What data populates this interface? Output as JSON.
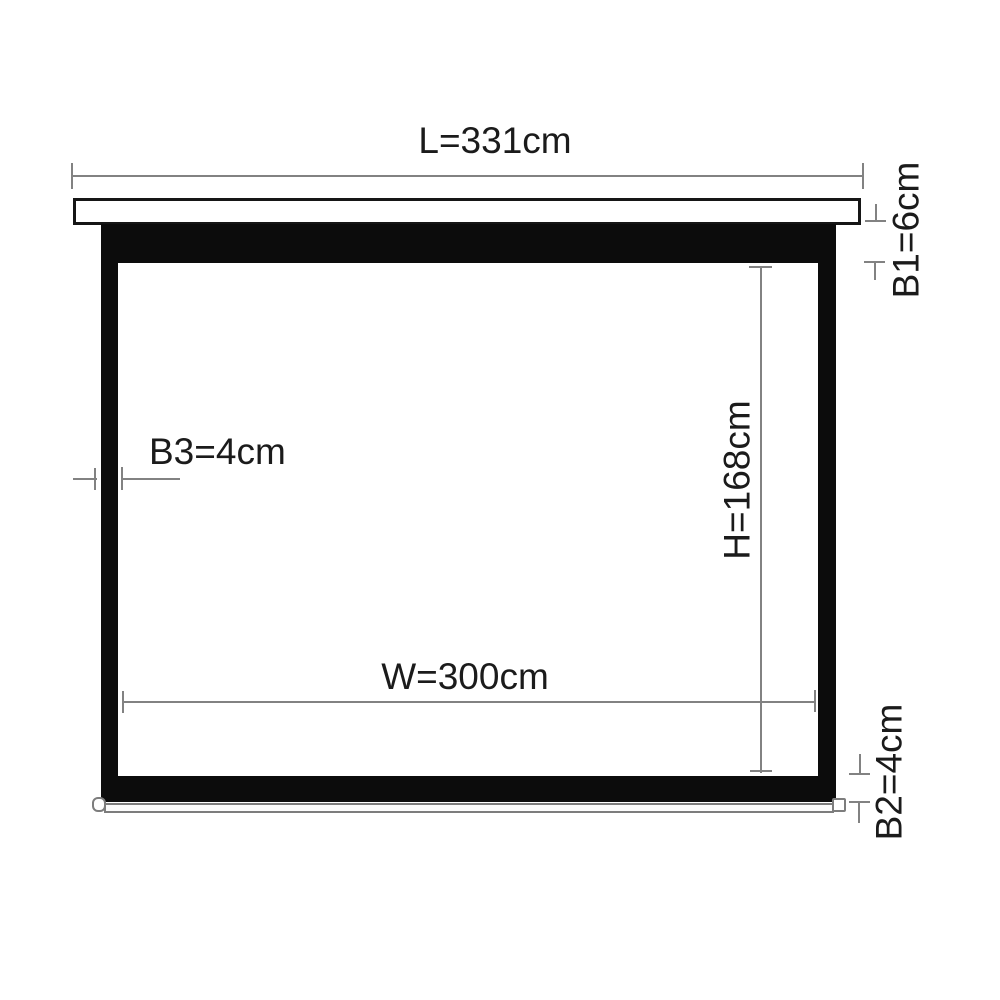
{
  "diagram": {
    "description_labels": {
      "length": "L=331cm",
      "border_top": "B1=6cm",
      "border_side": "B3=4cm",
      "height": "H=168cm",
      "width": "W=300cm",
      "border_bottom": "B2=4cm"
    },
    "values_cm": {
      "L": 331,
      "B1": 6,
      "B3": 4,
      "H": 168,
      "W": 300,
      "B2": 4
    },
    "colors": {
      "bg": "#ffffff",
      "ink": "#1b1b1b",
      "line": "#828282",
      "screen": "#0c0c0c",
      "casing_border": "#161616",
      "bar_border": "#7d7d7d",
      "bar_fill": "#fbfbfb"
    }
  }
}
